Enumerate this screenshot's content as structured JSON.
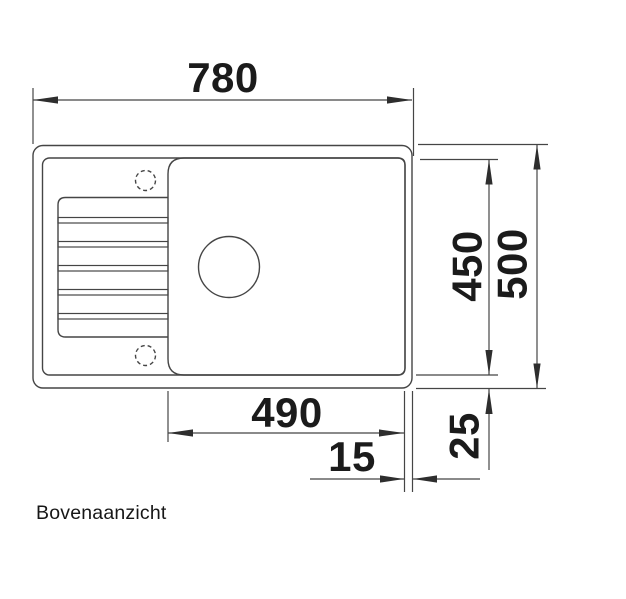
{
  "drawing": {
    "caption": "Bovenaanzicht",
    "dimensions": {
      "total_width": "780",
      "inner_depth": "450",
      "total_depth": "500",
      "bowl_width": "490",
      "rim_inset": "15",
      "edge_offset": "25"
    },
    "colors": {
      "line": "#454545",
      "arrow": "#2e2e2e",
      "text": "#1b1b1b",
      "background": "#ffffff"
    }
  }
}
